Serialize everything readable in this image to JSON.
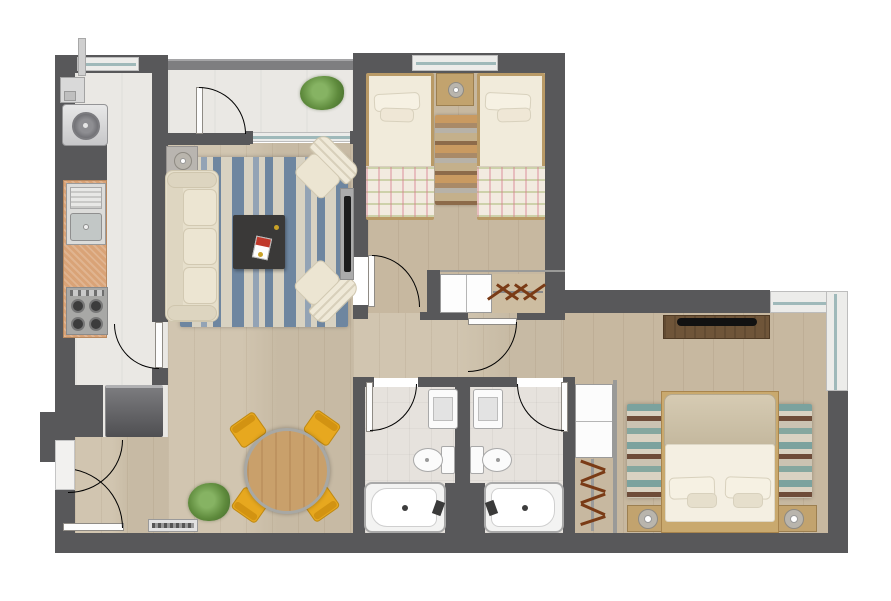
{
  "title": "apartment-floor-plan",
  "colors": {
    "wall": "#58585a",
    "wood": "#cdc0a9",
    "wood_dark": "#c7b8a0",
    "tile": "#eae8e4",
    "bath_tile": "#e6e2dd",
    "counter": "#d9a377",
    "rug_cream": "#d8d2c2",
    "rug_blue": "#6e86a0",
    "rug_teal": "#7ba29e",
    "rug_brown": "#6e4c39",
    "sofa": "#e6dfcb",
    "coffee_table": "#3a3938",
    "chair_yellow": "#e7a81f",
    "dining_wood": "#c9a06b",
    "plant_green": "#5e8a3c",
    "bed_linen": "#f1ebdb",
    "frame_wood": "#b99a66",
    "tv_wood": "#6f5539",
    "glazing": "#9fb9ba",
    "door_arc": "#8f8b85",
    "appliance_grey": "#5f5f63"
  },
  "rooms": [
    {
      "name": "terrace",
      "floor": "tile"
    },
    {
      "name": "laundry-nook",
      "floor": "tile"
    },
    {
      "name": "kitchen",
      "floor": "tile"
    },
    {
      "name": "living-room",
      "floor": "wood"
    },
    {
      "name": "dining-area",
      "floor": "wood"
    },
    {
      "name": "hallway",
      "floor": "wood"
    },
    {
      "name": "bedroom-2-twin",
      "floor": "wood"
    },
    {
      "name": "bathroom-1",
      "floor": "bath-tile"
    },
    {
      "name": "bathroom-2",
      "floor": "bath-tile"
    },
    {
      "name": "master-bedroom",
      "floor": "wood"
    }
  ],
  "elements": [
    "washing-machine",
    "kitchen-sink",
    "gas-stove-4-burner",
    "refrigerator",
    "sofa-3-seat",
    "armchair",
    "armchair",
    "coffee-table",
    "magazine",
    "tv-wall-panel",
    "side-table-lamp",
    "striped-rug-blue",
    "dining-table-round",
    "dining-chair-yellow-x4",
    "plant",
    "plant",
    "floor-vent",
    "twin-bed",
    "twin-bed",
    "shared-nightstand-lamp",
    "striped-runner-rug",
    "closet-shelves",
    "closet-hangers",
    "bathtub",
    "bathtub",
    "toilet",
    "toilet",
    "vanity-sink",
    "vanity-sink",
    "hall-closet-shelves",
    "hall-closet-hangers",
    "double-bed",
    "nightstand-lamp",
    "nightstand-lamp",
    "tv-console",
    "striped-rug-teal",
    "corner-window",
    "sliding-glass-door",
    "entry-door",
    "interior-door-x6",
    "window",
    "window",
    "utility-pipe"
  ]
}
